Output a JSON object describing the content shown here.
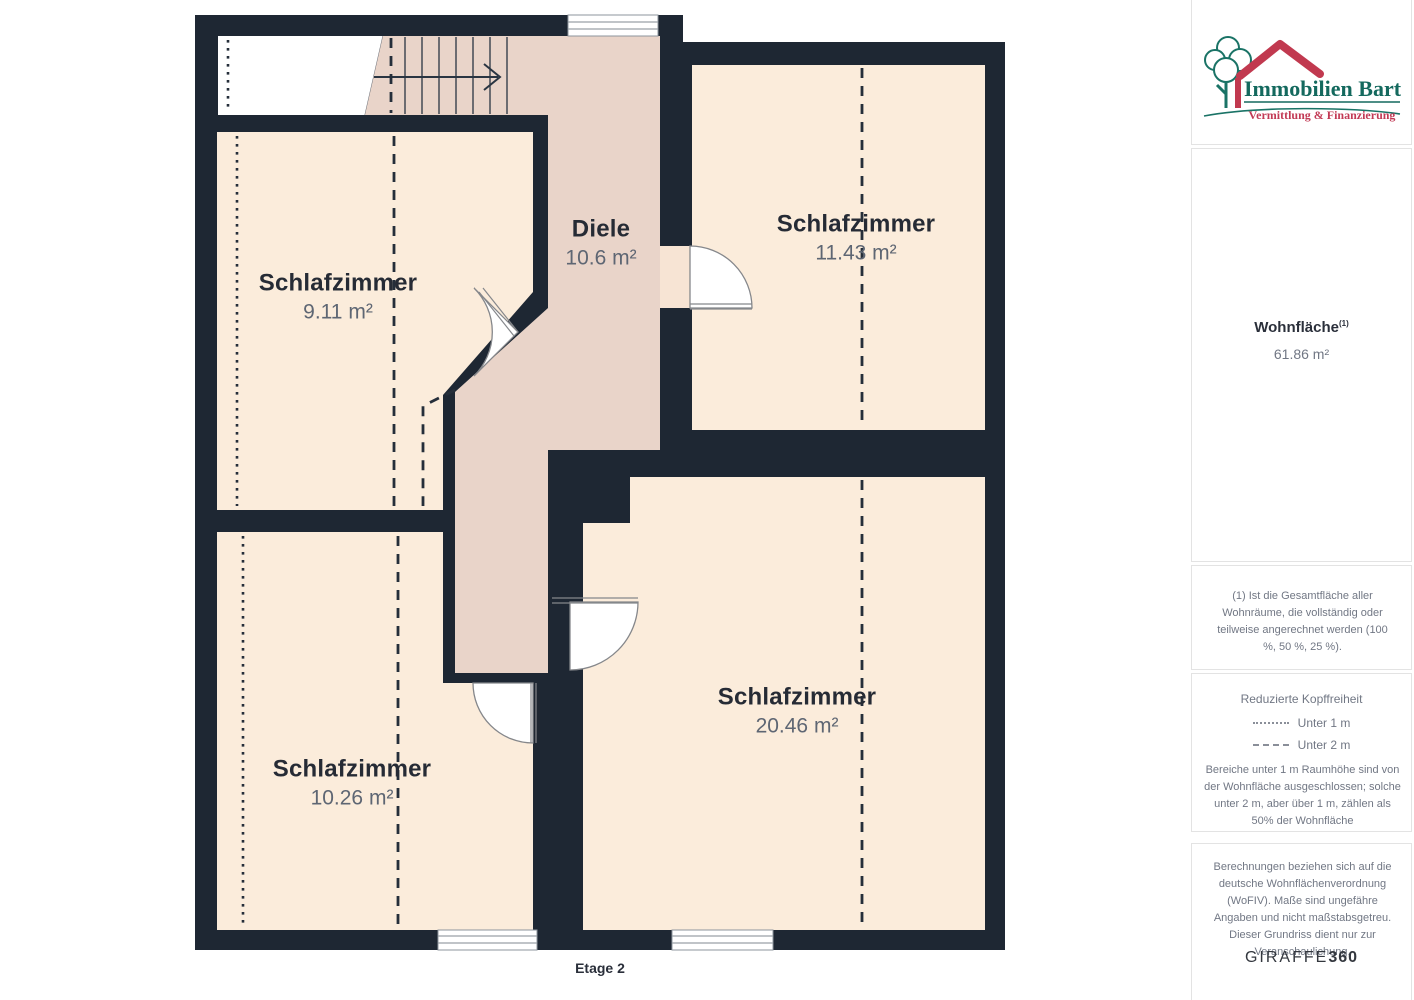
{
  "floorplan": {
    "floor_label": "Etage 2",
    "rooms": [
      {
        "name": "Schlafzimmer",
        "area": "9.11 m²"
      },
      {
        "name": "Diele",
        "area": "10.6 m²"
      },
      {
        "name": "Schlafzimmer",
        "area": "11.43 m²"
      },
      {
        "name": "Schlafzimmer",
        "area": "10.26 m²"
      },
      {
        "name": "Schlafzimmer",
        "area": "20.46 m²"
      }
    ],
    "colors": {
      "wall": "#1e2733",
      "room": "#fbecdb",
      "hall": "#e9d4c9"
    }
  },
  "sidebar": {
    "logo": {
      "title": "Immobilien Bart",
      "tagline": "Vermittlung & Finanzierung",
      "title_color": "#14695e",
      "tagline_color": "#c23a55"
    },
    "area_summary": {
      "label": "Wohnfläche",
      "superscript": "(1)",
      "value": "61.86 m²"
    },
    "footnote": "(1) Ist die Gesamtfläche aller Wohnräume, die vollständig oder teilweise angerechnet werden (100 %, 50 %, 25 %).",
    "legend": {
      "title": "Reduzierte Kopffreiheit",
      "items": [
        {
          "style": "dotted",
          "label": "Unter 1 m"
        },
        {
          "style": "dashed",
          "label": "Unter 2 m"
        }
      ],
      "note": "Bereiche unter 1 m Raumhöhe sind von der Wohnfläche ausgeschlossen; solche unter 2 m, aber über 1 m, zählen als 50% der Wohnfläche"
    },
    "disclaimer": "Berechnungen beziehen sich auf die deutsche Wohnflächenverordnung (WoFIV). Maße sind ungefähre Angaben und nicht maßstabsgetreu. Dieser Grundriss dient nur zur Veranschaulichung.",
    "brand": {
      "name": "GIRAFFE",
      "suffix": "360"
    }
  }
}
